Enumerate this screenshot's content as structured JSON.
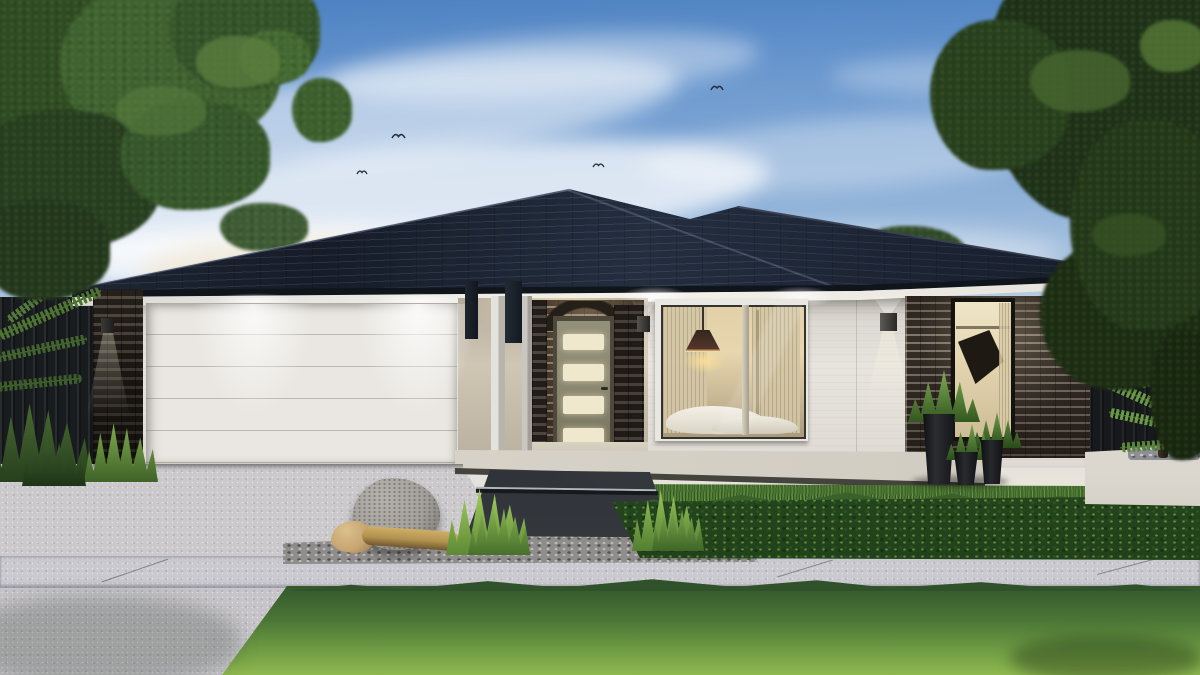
{
  "scene": {
    "type": "architectural exterior render",
    "time_of_day": "dusk",
    "subject": "single-storey house with charcoal tiled hip roof, white render walls, dark brick piers, double garage, recessed entry and landscaped front yard",
    "objects": [
      "dusk sky with wispy clouds",
      "flying birds",
      "overhanging tree canopy left",
      "dense dark trees right",
      "charcoal tiled hip roof with gutter and white fascia",
      "dark brick garage pier with cube wall light",
      "white sectional garage door washed by two downlights",
      "entry posts with dark battens",
      "recessed brick entry porch with arched brick header",
      "olive-grey front door with four frosted panels",
      "cube wall sconces with up-down light",
      "bedroom picture window with pendant lamp, sheer curtains and bed",
      "dark brick wing with tall lit window",
      "black tapered planter pots with agave plants",
      "dark slat fences left and right",
      "white rendered planter with pebbles and arching palm",
      "exposed aggregate concrete driveway",
      "light concrete footpath with joints",
      "charcoal stepped entry path",
      "gravel bed with granite boulder, tan rock and driftwood log",
      "ornamental grass tufts",
      "clipped leafy hedge row",
      "front lawn"
    ]
  },
  "palette": {
    "sky_top": "#4a7fc1",
    "sky_mid": "#93b4d9",
    "sky_low": "#d8dee4",
    "horizon_warm": "#f0e7d5",
    "cloud": "#ffffff",
    "roof_dark": "#161c28",
    "roof_mid": "#242e3f",
    "gutter": "#10141b",
    "fascia": "#edebe6",
    "wall": "#e7e4de",
    "wall_shade": "#c6c2bb",
    "brick_mortar": "#8d8478",
    "garage_door": "#eae7e2",
    "glow_warm": "#ffe9bd",
    "entry_door": "#8c8973",
    "door_panel": "#f0e8cd",
    "window_warm": "#e7d6ae",
    "curtain": "#d3c6a6",
    "pendant": "#31271e",
    "pot": "#0e1012",
    "planter_wall": "#dbd7cf",
    "fence": "#191c1f",
    "driveway": "#cbc9cc",
    "sidewalk": "#cac9d0",
    "path_dark": "#2d3136",
    "gravel": "#8f8d8b",
    "boulder": "#b5b2ad",
    "rock_tan": "#c7a571",
    "log": "#b2924f",
    "lawn_dark": "#35582c",
    "lawn_light": "#8fb850",
    "hedge": "#2f5526",
    "tree_dark": "#1c2d15",
    "tree_mid": "#2f4a22",
    "tree_hi": "#5d8040",
    "frond": "#6a9a45"
  }
}
